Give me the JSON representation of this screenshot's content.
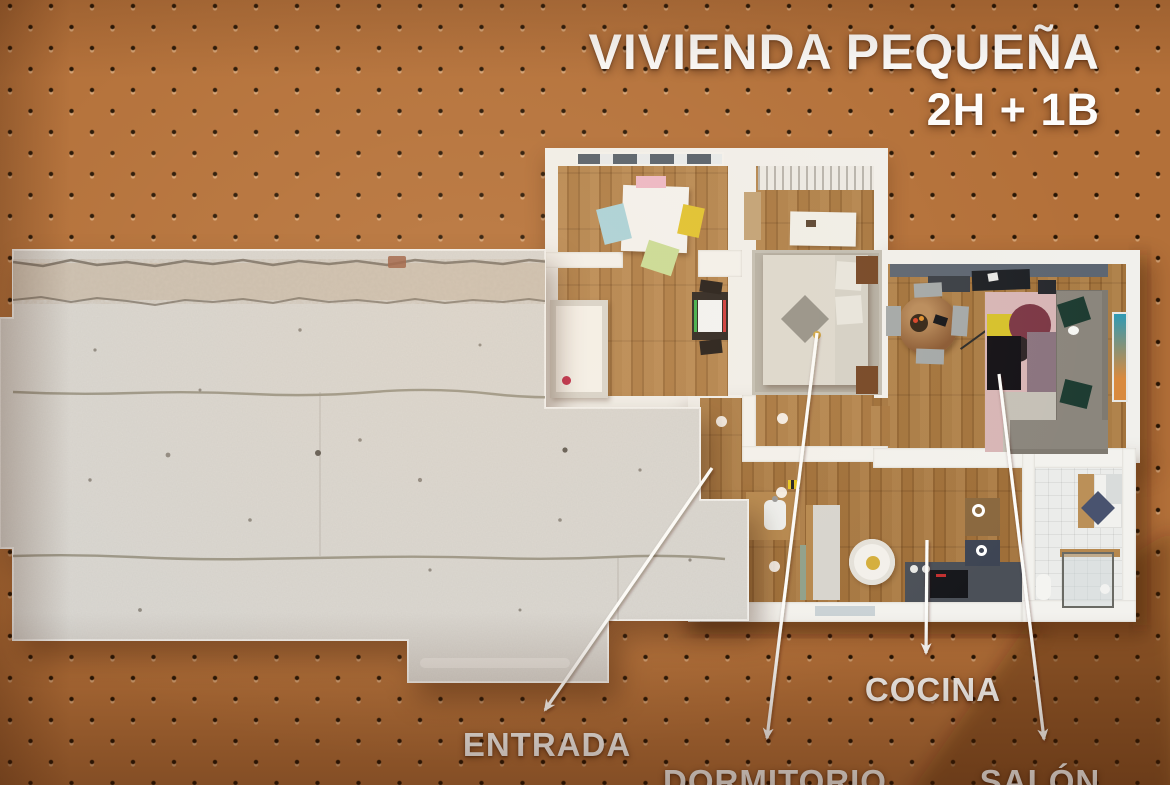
{
  "title": {
    "line1": "VIVIENDA PEQUEÑA",
    "line2": "2H + 1B"
  },
  "labels": [
    {
      "id": "entrada",
      "text": "ENTRADA",
      "x": 547,
      "y": 726,
      "arrow": {
        "x1": 712,
        "y1": 468,
        "x2": 545,
        "y2": 710
      }
    },
    {
      "id": "dormitorio",
      "text": "DORMITORIO",
      "x": 775,
      "y": 763,
      "arrow": {
        "x1": 817,
        "y1": 333,
        "x2": 767,
        "y2": 738
      }
    },
    {
      "id": "cocina",
      "text": "COCINA",
      "x": 933,
      "y": 671,
      "arrow": {
        "x1": 927,
        "y1": 540,
        "x2": 926,
        "y2": 653
      }
    },
    {
      "id": "salon",
      "text": "SALÓN",
      "x": 1040,
      "y": 763,
      "arrow": {
        "x1": 999,
        "y1": 374,
        "x2": 1044,
        "y2": 739
      }
    }
  ],
  "colors": {
    "pegboard": "#b37039",
    "dot": "#241303",
    "concrete": "#dad8d3",
    "wall": "#f1f0ec",
    "wood": "#a3743d",
    "label_text": "#fdfdfb"
  }
}
